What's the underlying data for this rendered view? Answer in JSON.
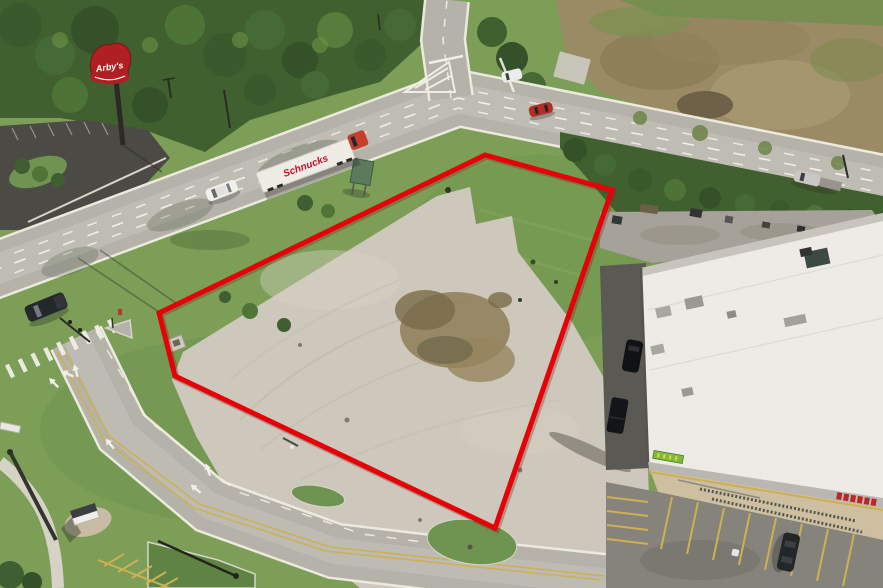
{
  "meta": {
    "title": "Aerial property photo",
    "description": "Drone aerial view of a vacant concrete commercial lot at a road intersection, outlined in red, beside an Arby's restaurant sign, a highway with a Schnucks semi trailer, and a grocery store building with parking lot."
  },
  "labels": {
    "arbys_sign": "Arby's",
    "schnucks_trailer": "Schnucks"
  },
  "property_outline": {
    "color": "#e60008",
    "stroke_width": 5,
    "points": "485,155 612,190 495,528 175,376 159,313"
  },
  "objects": [
    "red property boundary outline",
    "vacant concrete pad with dirt patch",
    "Arby's pole sign",
    "Arby's parking lot",
    "Schnucks semi trailer truck",
    "grocery store building with rooftop HVAC units",
    "store parking lot with yellow stalls and shopping cart rows",
    "highway intersection with crosswalk and turn arrows",
    "brown cleared field",
    "tree line",
    "vehicles on road",
    "street light median island",
    "monument sign"
  ],
  "colors": {
    "grass": "#7c9e57",
    "grass_dark": "#5f8342",
    "trees": "#41602f",
    "field": "#9b8b64",
    "road": "#b5b2a9",
    "road_edge": "#eceade",
    "lot_concrete": "#cdc8bb",
    "asphalt_dark": "#4b4a45",
    "dirt": "#8d7c57",
    "roof": "#edebe5",
    "sidewalk": "#cdbfa0",
    "parking": "#85837c",
    "marking_yellow": "#cdb054",
    "marking_white": "#f0efe9",
    "arbys_red": "#b01f24",
    "schnucks_red": "#c8102e",
    "store_banner_green": "#7fba3c"
  }
}
